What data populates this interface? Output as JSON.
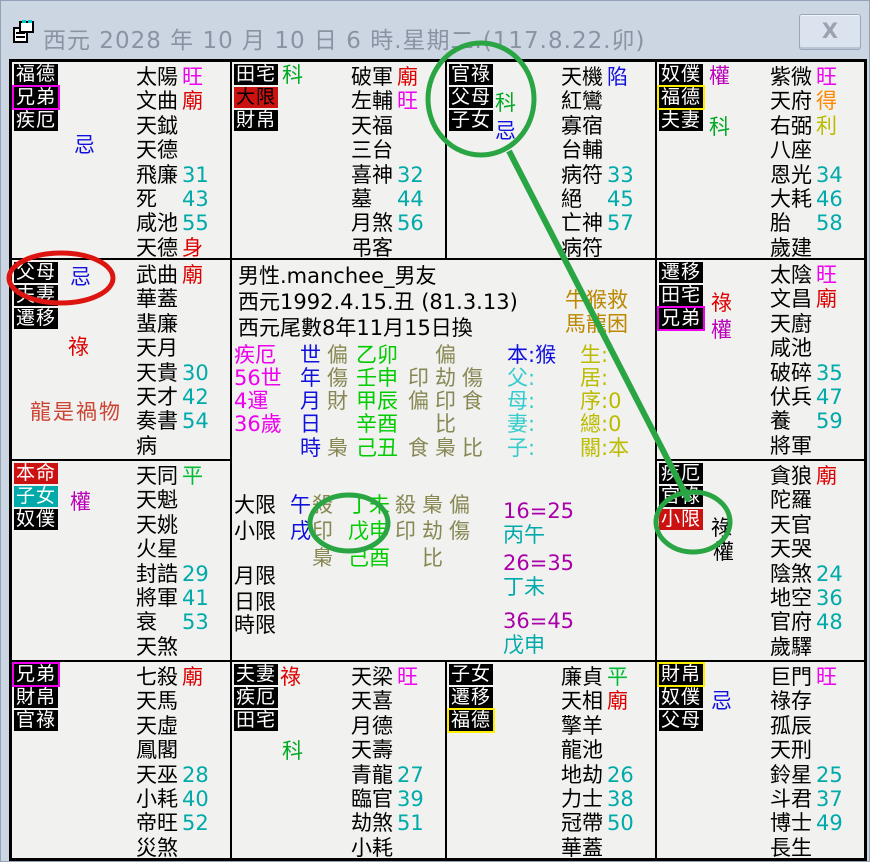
{
  "window": {
    "title": "西元 2028 年 10 月 10 日 6 時.星期二.(117.8.22.卯)",
    "close_label": "X"
  },
  "annotations": {
    "green_color": "#2aa544",
    "red_color": "#dd1511"
  },
  "palaces": [
    {
      "id": "si",
      "x": 0,
      "y": 0,
      "w": 220,
      "h": 198,
      "labels": [
        {
          "t": "福德"
        },
        {
          "t": "兄弟",
          "br": "#ee00ee"
        },
        {
          "t": "疾厄"
        }
      ],
      "marks": [
        {
          "t": "忌",
          "c": "#1111dd",
          "x": 62,
          "y": 72
        }
      ],
      "stars": [
        {
          "n": "太陽",
          "v": "旺",
          "c": "#ee00ee"
        },
        {
          "n": "文曲",
          "v": "廟",
          "c": "#dd0000"
        },
        {
          "n": "天鉞"
        },
        {
          "n": "天德"
        },
        {
          "n": "飛廉",
          "v": "31",
          "c": "#00aaaa"
        },
        {
          "n": "死",
          "v": "43",
          "c": "#00aaaa"
        },
        {
          "n": "咸池",
          "v": "55",
          "c": "#00aaaa"
        },
        {
          "n": "天德",
          "v": "身",
          "c": "#dd0000"
        }
      ]
    },
    {
      "id": "wu",
      "x": 220,
      "y": 0,
      "w": 215,
      "h": 198,
      "labels": [
        {
          "t": "田宅"
        },
        {
          "t": "大限",
          "bg": "#cc1111",
          "fg": "#000"
        },
        {
          "t": "財帛"
        }
      ],
      "marks": [
        {
          "t": "科",
          "c": "#00aa22",
          "x": 50,
          "y": 2
        }
      ],
      "stars": [
        {
          "n": "破軍",
          "v": "廟",
          "c": "#dd0000"
        },
        {
          "n": "左輔",
          "v": "旺",
          "c": "#ee00ee"
        },
        {
          "n": "天福"
        },
        {
          "n": "三台"
        },
        {
          "n": "喜神",
          "v": "32",
          "c": "#00aaaa"
        },
        {
          "n": "墓",
          "v": "44",
          "c": "#00aaaa"
        },
        {
          "n": "月煞",
          "v": "56",
          "c": "#00aaaa"
        },
        {
          "n": "弔客"
        }
      ]
    },
    {
      "id": "wei",
      "x": 435,
      "y": 0,
      "w": 210,
      "h": 198,
      "labels": [
        {
          "t": "官祿"
        },
        {
          "t": "父母"
        },
        {
          "t": "子女"
        }
      ],
      "marks": [
        {
          "t": "科",
          "c": "#00aa22",
          "x": 48,
          "y": 30
        },
        {
          "t": "忌",
          "c": "#1111dd",
          "x": 48,
          "y": 58
        }
      ],
      "stars": [
        {
          "n": "天機",
          "v": "陷",
          "c": "#1111dd"
        },
        {
          "n": "紅鸞"
        },
        {
          "n": "寡宿"
        },
        {
          "n": "台輔"
        },
        {
          "n": "病符",
          "v": "33",
          "c": "#00aaaa"
        },
        {
          "n": "絕",
          "v": "45",
          "c": "#00aaaa"
        },
        {
          "n": "亡神",
          "v": "57",
          "c": "#00aaaa"
        },
        {
          "n": "病符"
        }
      ]
    },
    {
      "id": "shen",
      "x": 645,
      "y": 0,
      "w": 209,
      "h": 198,
      "labels": [
        {
          "t": "奴僕"
        },
        {
          "t": "福德",
          "br": "#ffee00"
        },
        {
          "t": "夫妻"
        }
      ],
      "marks": [
        {
          "t": "權",
          "c": "#bb00bb",
          "x": 52,
          "y": 3
        },
        {
          "t": "科",
          "c": "#00aa22",
          "x": 52,
          "y": 54
        }
      ],
      "stars": [
        {
          "n": "紫微",
          "v": "旺",
          "c": "#ee00ee"
        },
        {
          "n": "天府",
          "v": "得",
          "c": "#ff8800"
        },
        {
          "n": "右弼",
          "v": "利",
          "c": "#bbbb00"
        },
        {
          "n": "八座"
        },
        {
          "n": "恩光",
          "v": "34",
          "c": "#00aaaa"
        },
        {
          "n": "大耗",
          "v": "46",
          "c": "#00aaaa"
        },
        {
          "n": "胎",
          "v": "58",
          "c": "#00aaaa"
        },
        {
          "n": "歲建"
        }
      ]
    },
    {
      "id": "chen",
      "x": 0,
      "y": 198,
      "w": 220,
      "h": 201,
      "labels": [
        {
          "t": "父母"
        },
        {
          "t": "夫妻"
        },
        {
          "t": "遷移"
        }
      ],
      "marks": [
        {
          "t": "忌",
          "c": "#1111dd",
          "x": 58,
          "y": 6
        },
        {
          "t": "祿",
          "c": "#dd0000",
          "x": 56,
          "y": 76
        }
      ],
      "extra": {
        "t": "龍是禍物",
        "x": 18,
        "y": 136,
        "c": "#cc4433"
      },
      "stars": [
        {
          "n": "武曲",
          "v": "廟",
          "c": "#dd0000"
        },
        {
          "n": "華蓋"
        },
        {
          "n": "蜚廉"
        },
        {
          "n": "天月"
        },
        {
          "n": "天貴",
          "v": "30",
          "c": "#00aaaa"
        },
        {
          "n": "天才",
          "v": "42",
          "c": "#00aaaa"
        },
        {
          "n": "奏書",
          "v": "54",
          "c": "#00aaaa"
        },
        {
          "n": "病"
        }
      ]
    },
    {
      "id": "you",
      "x": 645,
      "y": 198,
      "w": 209,
      "h": 201,
      "labels": [
        {
          "t": "遷移"
        },
        {
          "t": "田宅"
        },
        {
          "t": "兄弟",
          "br": "#ee00ee"
        }
      ],
      "marks": [
        {
          "t": "祿",
          "c": "#dd0000",
          "x": 54,
          "y": 32
        },
        {
          "t": "權",
          "c": "#bb00bb",
          "x": 54,
          "y": 59
        }
      ],
      "stars": [
        {
          "n": "太陰",
          "v": "旺",
          "c": "#ee00ee"
        },
        {
          "n": "文昌",
          "v": "廟",
          "c": "#dd0000"
        },
        {
          "n": "天廚"
        },
        {
          "n": "咸池"
        },
        {
          "n": "破碎",
          "v": "35",
          "c": "#00aaaa"
        },
        {
          "n": "伏兵",
          "v": "47",
          "c": "#00aaaa"
        },
        {
          "n": "養",
          "v": "59",
          "c": "#00aaaa"
        },
        {
          "n": "將軍"
        }
      ]
    },
    {
      "id": "mao",
      "x": 0,
      "y": 399,
      "w": 220,
      "h": 201,
      "labels": [
        {
          "t": "本命",
          "bg": "#cc1111",
          "fg": "#fff"
        },
        {
          "t": "子女",
          "bg": "#00aaaa",
          "fg": "#fff"
        },
        {
          "t": "奴僕"
        }
      ],
      "marks": [
        {
          "t": "權",
          "c": "#bb00bb",
          "x": 58,
          "y": 30
        }
      ],
      "stars": [
        {
          "n": "天同",
          "v": "平",
          "c": "#00bb33"
        },
        {
          "n": "天魁"
        },
        {
          "n": "天姚"
        },
        {
          "n": "火星"
        },
        {
          "n": "封誥",
          "v": "29",
          "c": "#00aaaa"
        },
        {
          "n": "將軍",
          "v": "41",
          "c": "#00aaaa"
        },
        {
          "n": "衰",
          "v": "53",
          "c": "#00aaaa"
        },
        {
          "n": "天煞"
        }
      ]
    },
    {
      "id": "xu",
      "x": 645,
      "y": 399,
      "w": 209,
      "h": 201,
      "labels": [
        {
          "t": "疾厄"
        },
        {
          "t": "官祿"
        },
        {
          "t": "小限",
          "bg": "#cc1111",
          "fg": "#fff"
        }
      ],
      "marks": [
        {
          "t": "祿",
          "c": "#000000",
          "x": 54,
          "y": 56
        },
        {
          "t": "權",
          "c": "#000000",
          "x": 56,
          "y": 80
        }
      ],
      "stars": [
        {
          "n": "貪狼",
          "v": "廟",
          "c": "#dd0000"
        },
        {
          "n": "陀羅"
        },
        {
          "n": "天官"
        },
        {
          "n": "天哭"
        },
        {
          "n": "陰煞",
          "v": "24",
          "c": "#00aaaa"
        },
        {
          "n": "地空",
          "v": "36",
          "c": "#00aaaa"
        },
        {
          "n": "官府",
          "v": "48",
          "c": "#00aaaa"
        },
        {
          "n": "歲驛"
        }
      ]
    },
    {
      "id": "yin",
      "x": 0,
      "y": 600,
      "w": 220,
      "h": 198,
      "labels": [
        {
          "t": "兄弟",
          "br": "#ee00ee"
        },
        {
          "t": "財帛"
        },
        {
          "t": "官祿"
        }
      ],
      "stars": [
        {
          "n": "七殺",
          "v": "廟",
          "c": "#dd0000"
        },
        {
          "n": "天馬"
        },
        {
          "n": "天虛"
        },
        {
          "n": "鳳閣"
        },
        {
          "n": "天巫",
          "v": "28",
          "c": "#00aaaa"
        },
        {
          "n": "小耗",
          "v": "40",
          "c": "#00aaaa"
        },
        {
          "n": "帝旺",
          "v": "52",
          "c": "#00aaaa"
        },
        {
          "n": "災煞"
        }
      ]
    },
    {
      "id": "chou",
      "x": 220,
      "y": 600,
      "w": 215,
      "h": 198,
      "labels": [
        {
          "t": "夫妻"
        },
        {
          "t": "疾厄"
        },
        {
          "t": "田宅"
        }
      ],
      "marks": [
        {
          "t": "祿",
          "c": "#dd0000",
          "x": 48,
          "y": 4
        },
        {
          "t": "科",
          "c": "#00aa22",
          "x": 50,
          "y": 78
        }
      ],
      "stars": [
        {
          "n": "天梁",
          "v": "旺",
          "c": "#ee00ee"
        },
        {
          "n": "天喜"
        },
        {
          "n": "月德"
        },
        {
          "n": "天壽"
        },
        {
          "n": "青龍",
          "v": "27",
          "c": "#00aaaa"
        },
        {
          "n": "臨官",
          "v": "39",
          "c": "#00aaaa"
        },
        {
          "n": "劫煞",
          "v": "51",
          "c": "#00aaaa"
        },
        {
          "n": "小耗"
        }
      ]
    },
    {
      "id": "zi",
      "x": 435,
      "y": 600,
      "w": 210,
      "h": 198,
      "labels": [
        {
          "t": "子女"
        },
        {
          "t": "遷移"
        },
        {
          "t": "福德",
          "br": "#ffee00"
        }
      ],
      "stars": [
        {
          "n": "廉貞",
          "v": "平",
          "c": "#00bb33"
        },
        {
          "n": "天相",
          "v": "廟",
          "c": "#dd0000"
        },
        {
          "n": "擎羊"
        },
        {
          "n": "龍池"
        },
        {
          "n": "地劫",
          "v": "26",
          "c": "#00aaaa"
        },
        {
          "n": "力士",
          "v": "38",
          "c": "#00aaaa"
        },
        {
          "n": "冠帶",
          "v": "50",
          "c": "#00aaaa"
        },
        {
          "n": "華蓋"
        }
      ]
    },
    {
      "id": "hai",
      "x": 645,
      "y": 600,
      "w": 209,
      "h": 198,
      "labels": [
        {
          "t": "財帛",
          "br": "#ffee00"
        },
        {
          "t": "奴僕"
        },
        {
          "t": "父母"
        }
      ],
      "marks": [
        {
          "t": "忌",
          "c": "#1111dd",
          "x": 54,
          "y": 28
        }
      ],
      "stars": [
        {
          "n": "巨門",
          "v": "旺",
          "c": "#ee00ee"
        },
        {
          "n": "祿存"
        },
        {
          "n": "孤辰"
        },
        {
          "n": "天刑"
        },
        {
          "n": "鈴星",
          "v": "25",
          "c": "#00aaaa"
        },
        {
          "n": "斗君",
          "v": "37",
          "c": "#00aaaa"
        },
        {
          "n": "博士",
          "v": "49",
          "c": "#00aaaa"
        },
        {
          "n": "長生"
        }
      ]
    }
  ],
  "center": {
    "items": [
      {
        "n": "person-line",
        "t": "男性.manchee_男友",
        "x": 6,
        "y": 5,
        "c": "#000000"
      },
      {
        "n": "birth-line",
        "t": "西元1992.4.15.丑 (81.3.13)",
        "x": 6,
        "y": 31,
        "c": "#000000"
      },
      {
        "n": "change-line",
        "t": "西元尾數8年11月15日換",
        "x": 6,
        "y": 57,
        "c": "#000000"
      },
      {
        "n": "hint-line-1",
        "t": "牛猴救",
        "x": 333,
        "y": 29,
        "c": "#bb8800"
      },
      {
        "n": "hint-line-2",
        "t": "馬龍困",
        "x": 333,
        "y": 53,
        "c": "#bb8800"
      },
      {
        "t": "疾厄",
        "x": 2,
        "y": 84,
        "c": "#ee00ee"
      },
      {
        "t": "世",
        "x": 68,
        "y": 84,
        "c": "#1111dd"
      },
      {
        "t": "偏",
        "x": 95,
        "y": 84,
        "c": "#888855"
      },
      {
        "t": "乙卯",
        "x": 124,
        "y": 84,
        "c": "#00cc00"
      },
      {
        "t": "偏",
        "x": 203,
        "y": 84,
        "c": "#888855"
      },
      {
        "t": "本:猴",
        "x": 275,
        "y": 84,
        "c": "#1111dd"
      },
      {
        "t": "生:",
        "x": 348,
        "y": 84,
        "c": "#bbbb00"
      },
      {
        "t": "56世",
        "x": 2,
        "y": 107,
        "c": "#ee00ee"
      },
      {
        "t": "年",
        "x": 68,
        "y": 107,
        "c": "#1111dd"
      },
      {
        "t": "傷",
        "x": 95,
        "y": 107,
        "c": "#888855"
      },
      {
        "t": "壬申",
        "x": 124,
        "y": 107,
        "c": "#00cc00"
      },
      {
        "t": "印",
        "x": 176,
        "y": 107,
        "c": "#888855"
      },
      {
        "t": "劫",
        "x": 203,
        "y": 107,
        "c": "#888855"
      },
      {
        "t": "傷",
        "x": 230,
        "y": 107,
        "c": "#888855"
      },
      {
        "t": "父:",
        "x": 275,
        "y": 107,
        "c": "#33cccc"
      },
      {
        "t": "居:",
        "x": 348,
        "y": 107,
        "c": "#bbbb00"
      },
      {
        "t": "4運",
        "x": 2,
        "y": 130,
        "c": "#ee00ee"
      },
      {
        "t": "月",
        "x": 68,
        "y": 130,
        "c": "#1111dd"
      },
      {
        "t": "財",
        "x": 95,
        "y": 130,
        "c": "#888855"
      },
      {
        "t": "甲辰",
        "x": 124,
        "y": 130,
        "c": "#00cc00"
      },
      {
        "t": "偏",
        "x": 176,
        "y": 130,
        "c": "#888855"
      },
      {
        "t": "印",
        "x": 203,
        "y": 130,
        "c": "#888855"
      },
      {
        "t": "食",
        "x": 230,
        "y": 130,
        "c": "#888855"
      },
      {
        "t": "母:",
        "x": 275,
        "y": 130,
        "c": "#33cccc"
      },
      {
        "t": "序:0",
        "x": 348,
        "y": 130,
        "c": "#bbbb00"
      },
      {
        "t": "36歲",
        "x": 2,
        "y": 153,
        "c": "#ee00ee"
      },
      {
        "t": "日",
        "x": 68,
        "y": 153,
        "c": "#1111dd"
      },
      {
        "t": "辛酉",
        "x": 124,
        "y": 153,
        "c": "#00cc00"
      },
      {
        "t": "比",
        "x": 203,
        "y": 153,
        "c": "#888855"
      },
      {
        "t": "妻:",
        "x": 275,
        "y": 153,
        "c": "#33cccc"
      },
      {
        "t": "總:0",
        "x": 348,
        "y": 153,
        "c": "#bbbb00"
      },
      {
        "t": "時",
        "x": 68,
        "y": 177,
        "c": "#1111dd"
      },
      {
        "t": "梟",
        "x": 95,
        "y": 177,
        "c": "#888855"
      },
      {
        "t": "己丑",
        "x": 124,
        "y": 177,
        "c": "#00cc00"
      },
      {
        "t": "食",
        "x": 176,
        "y": 177,
        "c": "#888855"
      },
      {
        "t": "梟",
        "x": 203,
        "y": 177,
        "c": "#888855"
      },
      {
        "t": "比",
        "x": 230,
        "y": 177,
        "c": "#888855"
      },
      {
        "t": "子:",
        "x": 275,
        "y": 177,
        "c": "#33cccc"
      },
      {
        "t": "關:本",
        "x": 348,
        "y": 177,
        "c": "#bbbb00"
      },
      {
        "n": "daxian-label",
        "t": "大限",
        "x": 2,
        "y": 234,
        "c": "#000000"
      },
      {
        "t": "午",
        "x": 58,
        "y": 234,
        "c": "#1111dd"
      },
      {
        "t": "殺",
        "x": 80,
        "y": 234,
        "c": "#888855"
      },
      {
        "t": "丁未",
        "x": 116,
        "y": 234,
        "c": "#00cc00"
      },
      {
        "t": "殺",
        "x": 163,
        "y": 234,
        "c": "#888855"
      },
      {
        "t": "梟",
        "x": 190,
        "y": 234,
        "c": "#888855"
      },
      {
        "t": "偏",
        "x": 217,
        "y": 234,
        "c": "#888855"
      },
      {
        "n": "xiaoxian-label",
        "t": "小限",
        "x": 2,
        "y": 260,
        "c": "#000000"
      },
      {
        "t": "戌",
        "x": 58,
        "y": 260,
        "c": "#1111dd"
      },
      {
        "t": "印",
        "x": 80,
        "y": 260,
        "c": "#888855"
      },
      {
        "t": "戊申",
        "x": 116,
        "y": 260,
        "c": "#00cc00"
      },
      {
        "t": "印",
        "x": 163,
        "y": 260,
        "c": "#888855"
      },
      {
        "t": "劫",
        "x": 190,
        "y": 260,
        "c": "#888855"
      },
      {
        "t": "傷",
        "x": 217,
        "y": 260,
        "c": "#888855"
      },
      {
        "t": "梟",
        "x": 80,
        "y": 287,
        "c": "#888855"
      },
      {
        "t": "己酉",
        "x": 116,
        "y": 287,
        "c": "#00cc00"
      },
      {
        "t": "比",
        "x": 190,
        "y": 287,
        "c": "#888855"
      },
      {
        "n": "yuexian-label",
        "t": "月限",
        "x": 2,
        "y": 305,
        "c": "#000000"
      },
      {
        "n": "rixian-label",
        "t": "日限",
        "x": 2,
        "y": 331,
        "c": "#000000"
      },
      {
        "n": "shixian-label",
        "t": "時限",
        "x": 2,
        "y": 354,
        "c": "#000000"
      },
      {
        "n": "age-range-1",
        "t": "16=25",
        "x": 271,
        "y": 240,
        "c": "#aa00aa"
      },
      {
        "n": "age-gz-1",
        "t": "丙午",
        "x": 271,
        "y": 264,
        "c": "#00aaaa"
      },
      {
        "n": "age-range-2",
        "t": "26=35",
        "x": 271,
        "y": 292,
        "c": "#aa00aa"
      },
      {
        "n": "age-gz-2",
        "t": "丁未",
        "x": 271,
        "y": 316,
        "c": "#00aaaa"
      },
      {
        "n": "age-range-3",
        "t": "36=45",
        "x": 271,
        "y": 350,
        "c": "#aa00aa"
      },
      {
        "n": "age-gz-3",
        "t": "戊申",
        "x": 271,
        "y": 374,
        "c": "#00aaaa"
      }
    ]
  }
}
